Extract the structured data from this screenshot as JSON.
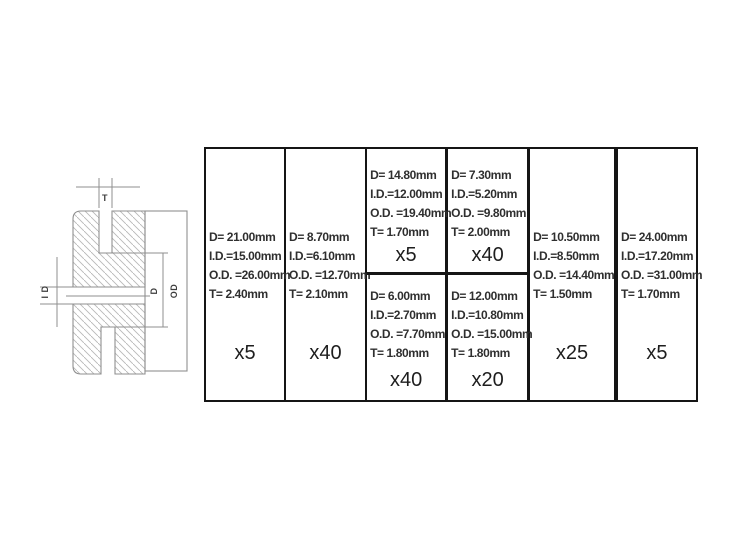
{
  "diagram": {
    "labels": {
      "t": "T",
      "id": "I D",
      "d": "D",
      "od": "OD"
    }
  },
  "table": {
    "columns": [
      {
        "cells": [
          {
            "lines": [
              "D= 21.00mm",
              "I.D.=15.00mm",
              "O.D. =26.00mm",
              "T= 2.40mm"
            ],
            "qty": "x5"
          }
        ]
      },
      {
        "cells": [
          {
            "lines": [
              "D= 8.70mm",
              "I.D.=6.10mm",
              "O.D. =12.70mm",
              "T= 2.10mm"
            ],
            "qty": "x40"
          }
        ]
      },
      {
        "cells": [
          {
            "lines": [
              "D= 14.80mm",
              "I.D.=12.00mm",
              "O.D. =19.40mm",
              "T= 1.70mm"
            ],
            "qty": "x5"
          },
          {
            "lines": [
              "D= 6.00mm",
              "I.D.=2.70mm",
              "O.D. =7.70mm",
              "T= 1.80mm"
            ],
            "qty": "x40"
          }
        ]
      },
      {
        "cells": [
          {
            "lines": [
              "D= 7.30mm",
              "I.D.=5.20mm",
              "O.D. =9.80mm",
              "T= 2.00mm"
            ],
            "qty": "x40"
          },
          {
            "lines": [
              "D= 12.00mm",
              "I.D.=10.80mm",
              "O.D. =15.00mm",
              "T= 1.80mm"
            ],
            "qty": "x20"
          }
        ]
      },
      {
        "cells": [
          {
            "lines": [
              "D= 10.50mm",
              "I.D.=8.50mm",
              "O.D. =14.40mm",
              "T= 1.50mm"
            ],
            "qty": "x25"
          }
        ]
      },
      {
        "cells": [
          {
            "lines": [
              "D= 24.00mm",
              "I.D.=17.20mm",
              "O.D. =31.00mm",
              "T= 1.70mm"
            ],
            "qty": "x5"
          }
        ]
      }
    ]
  },
  "colors": {
    "table_border": "#151515",
    "spec_text": "#2f2f2f",
    "qty_text": "#1e1e1e",
    "drawing_line": "#8f8f8f",
    "hatch_line": "#b8b8b8",
    "label_text": "#3d3d3d"
  }
}
